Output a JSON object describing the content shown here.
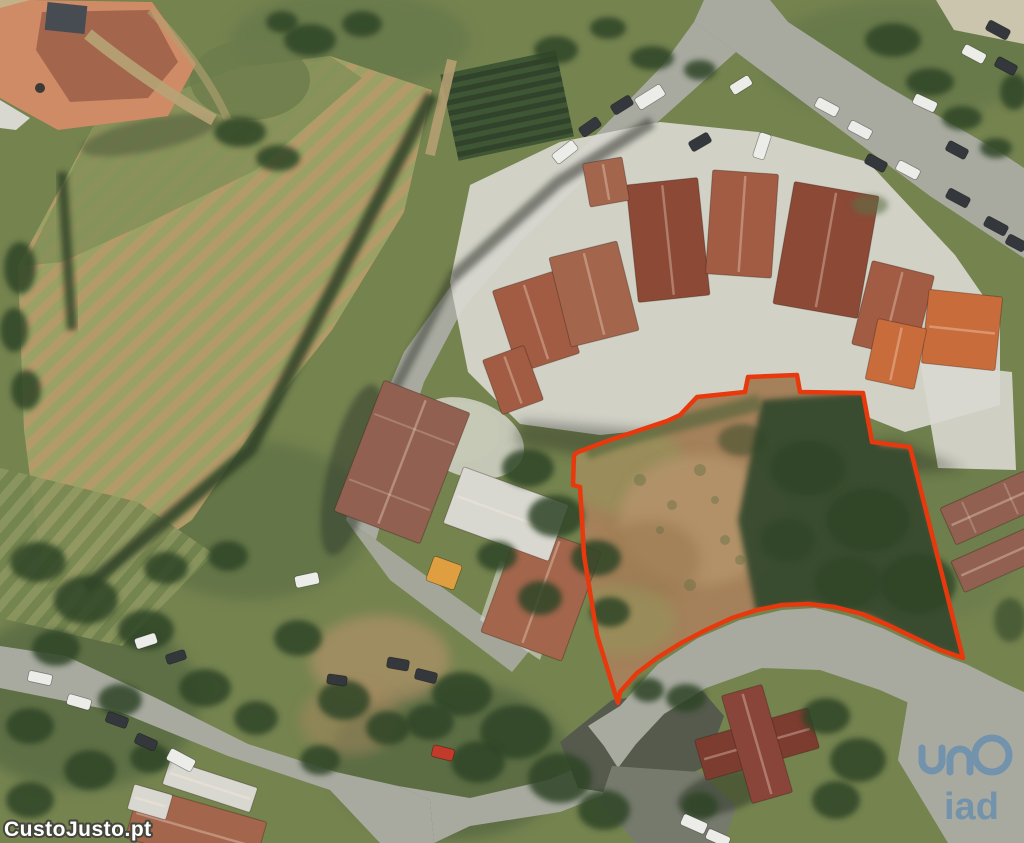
{
  "meta": {
    "canvas": {
      "width": 1024,
      "height": 843
    }
  },
  "watermarks": {
    "site": {
      "text": "CustoJusto.pt",
      "fill": "#ffffff",
      "outline": "#45453c"
    },
    "agency": {
      "text": "iad",
      "color": "#3f7cb8"
    }
  },
  "plot": {
    "outline_color": "#e8380d",
    "outline_width": 4.5,
    "outline_points": "618,703 597,635 584,555 580,487 573,485 574,455 578,452 610,440 637,431 667,421 680,415 697,397 745,392 748,377 797,375 800,392 863,393 872,442 910,447 963,658 940,650 915,638 888,625 862,614 835,607 808,604 782,605 757,610 732,618 706,630 681,643 657,658 637,673 620,692"
  },
  "palette": {
    "base": "#75834f",
    "field-tan": "#b39b69",
    "field-olive": "#9ba164",
    "veg-dark": "#2e4026",
    "garden-green": "#3f5634",
    "garden-dark": "#31432a",
    "plot-veg": "#36492d",
    "road": "#a8aaa0",
    "asphalt": "#565a4d",
    "asphalt2": "#767a6c",
    "gravel": "#cbc5ad",
    "dirt": "#a4815a",
    "dirt-light": "#b4936a",
    "scrub-green": "#5f7045",
    "wall": "#d9d8d0",
    "roof-salmon": "#cf8a66",
    "roof-salmon-dark": "#a3664c",
    "roof-terracotta": "#a15c43",
    "roof-dark": "#8b4936",
    "roof-bright": "#c96c3c",
    "roof-weathered": "#916050",
    "roof-maroon": "#7c3c30",
    "roof-maroon2": "#8a453a",
    "tree": "#2f4428",
    "red-line": "#e8380d",
    "car-white": "#ecece8",
    "car-dark": "#34383c",
    "car-red": "#c23a2a",
    "container-orange": "#df9e3f",
    "wm-fill": "#ffffff",
    "wm-stroke": "#45453c",
    "logo-blue": "#3f7cb8"
  },
  "scene": {
    "roofs": [
      {
        "x": 536,
        "y": 322,
        "w": 64,
        "h": 86,
        "r": -18,
        "c": "roof-terracotta"
      },
      {
        "x": 594,
        "y": 294,
        "w": 70,
        "h": 92,
        "r": -14,
        "c": "roof-salmon-dark"
      },
      {
        "x": 668,
        "y": 240,
        "w": 72,
        "h": 118,
        "r": -6,
        "c": "roof-dark"
      },
      {
        "x": 742,
        "y": 224,
        "w": 66,
        "h": 104,
        "r": 4,
        "c": "roof-terracotta"
      },
      {
        "x": 826,
        "y": 250,
        "w": 86,
        "h": 124,
        "r": 10,
        "c": "roof-dark"
      },
      {
        "x": 893,
        "y": 310,
        "w": 64,
        "h": 86,
        "r": 14,
        "c": "roof-terracotta"
      },
      {
        "x": 962,
        "y": 330,
        "w": 74,
        "h": 74,
        "r": 6,
        "c": "roof-bright"
      },
      {
        "x": 896,
        "y": 354,
        "w": 50,
        "h": 62,
        "r": 12,
        "c": "roof-bright"
      },
      {
        "x": 513,
        "y": 380,
        "w": 44,
        "h": 58,
        "r": -20,
        "c": "roof-terracotta"
      },
      {
        "x": 606,
        "y": 182,
        "w": 40,
        "h": 44,
        "r": -10,
        "c": "roof-salmon-dark"
      },
      {
        "x": 402,
        "y": 462,
        "w": 92,
        "h": 140,
        "r": 21,
        "c": "roof-weathered",
        "s": 1
      },
      {
        "x": 541,
        "y": 592,
        "w": 86,
        "h": 116,
        "r": 20,
        "c": "roof-salmon-dark"
      },
      {
        "x": 506,
        "y": 514,
        "w": 112,
        "h": 60,
        "r": 20,
        "c": "wall"
      },
      {
        "x": 210,
        "y": 786,
        "w": 92,
        "h": 26,
        "r": 18,
        "c": "wall"
      },
      {
        "x": 196,
        "y": 830,
        "w": 132,
        "h": 54,
        "r": 16,
        "c": "roof-salmon-dark"
      },
      {
        "x": 150,
        "y": 802,
        "w": 40,
        "h": 26,
        "r": 16,
        "c": "wall"
      },
      {
        "x": 990,
        "y": 508,
        "w": 92,
        "h": 40,
        "r": -24,
        "c": "roof-weathered",
        "s": 1
      },
      {
        "x": 996,
        "y": 560,
        "w": 84,
        "h": 34,
        "r": -24,
        "c": "roof-weathered"
      },
      {
        "x": 757,
        "y": 744,
        "w": 118,
        "h": 42,
        "r": -16,
        "c": "roof-maroon"
      },
      {
        "x": 757,
        "y": 744,
        "w": 42,
        "h": 112,
        "r": -16,
        "c": "roof-maroon2"
      }
    ],
    "trees": [
      {
        "x": 310,
        "y": 40,
        "rx": 26,
        "ry": 16
      },
      {
        "x": 362,
        "y": 24,
        "rx": 20,
        "ry": 13
      },
      {
        "x": 282,
        "y": 22,
        "rx": 16,
        "ry": 11
      },
      {
        "x": 556,
        "y": 50,
        "rx": 22,
        "ry": 14
      },
      {
        "x": 608,
        "y": 28,
        "rx": 18,
        "ry": 11
      },
      {
        "x": 652,
        "y": 58,
        "rx": 22,
        "ry": 12
      },
      {
        "x": 700,
        "y": 70,
        "rx": 16,
        "ry": 10
      },
      {
        "x": 893,
        "y": 40,
        "rx": 28,
        "ry": 17
      },
      {
        "x": 930,
        "y": 82,
        "rx": 24,
        "ry": 14
      },
      {
        "x": 962,
        "y": 118,
        "rx": 20,
        "ry": 12
      },
      {
        "x": 996,
        "y": 148,
        "rx": 16,
        "ry": 10
      },
      {
        "x": 1014,
        "y": 92,
        "rx": 14,
        "ry": 18
      },
      {
        "x": 870,
        "y": 205,
        "rx": 18,
        "ry": 10,
        "c": "scrub-green",
        "o": 0.6
      },
      {
        "x": 20,
        "y": 268,
        "rx": 16,
        "ry": 26
      },
      {
        "x": 14,
        "y": 330,
        "rx": 14,
        "ry": 22
      },
      {
        "x": 26,
        "y": 390,
        "rx": 15,
        "ry": 20
      },
      {
        "x": 240,
        "y": 132,
        "rx": 26,
        "ry": 15
      },
      {
        "x": 278,
        "y": 158,
        "rx": 22,
        "ry": 13
      },
      {
        "x": 528,
        "y": 468,
        "rx": 26,
        "ry": 19
      },
      {
        "x": 556,
        "y": 516,
        "rx": 28,
        "ry": 21
      },
      {
        "x": 596,
        "y": 558,
        "rx": 25,
        "ry": 18
      },
      {
        "x": 540,
        "y": 598,
        "rx": 22,
        "ry": 17
      },
      {
        "x": 497,
        "y": 556,
        "rx": 20,
        "ry": 15
      },
      {
        "x": 610,
        "y": 612,
        "rx": 20,
        "ry": 15
      },
      {
        "x": 808,
        "y": 468,
        "rx": 38,
        "ry": 28,
        "o": 0.75
      },
      {
        "x": 868,
        "y": 520,
        "rx": 42,
        "ry": 32,
        "o": 0.8
      },
      {
        "x": 918,
        "y": 584,
        "rx": 38,
        "ry": 30,
        "o": 0.8
      },
      {
        "x": 848,
        "y": 582,
        "rx": 34,
        "ry": 26,
        "o": 0.7
      },
      {
        "x": 788,
        "y": 540,
        "rx": 28,
        "ry": 22,
        "o": 0.65
      },
      {
        "x": 742,
        "y": 440,
        "rx": 24,
        "ry": 16,
        "o": 0.5
      },
      {
        "x": 462,
        "y": 694,
        "rx": 30,
        "ry": 22
      },
      {
        "x": 516,
        "y": 732,
        "rx": 36,
        "ry": 27
      },
      {
        "x": 560,
        "y": 778,
        "rx": 32,
        "ry": 25
      },
      {
        "x": 478,
        "y": 762,
        "rx": 27,
        "ry": 21
      },
      {
        "x": 604,
        "y": 810,
        "rx": 26,
        "ry": 20
      },
      {
        "x": 430,
        "y": 722,
        "rx": 24,
        "ry": 18
      },
      {
        "x": 686,
        "y": 698,
        "rx": 20,
        "ry": 14
      },
      {
        "x": 826,
        "y": 716,
        "rx": 24,
        "ry": 18
      },
      {
        "x": 858,
        "y": 760,
        "rx": 28,
        "ry": 22
      },
      {
        "x": 836,
        "y": 800,
        "rx": 24,
        "ry": 19
      },
      {
        "x": 700,
        "y": 806,
        "rx": 18,
        "ry": 14
      },
      {
        "x": 648,
        "y": 690,
        "rx": 16,
        "ry": 12
      },
      {
        "x": 38,
        "y": 562,
        "rx": 28,
        "ry": 20
      },
      {
        "x": 86,
        "y": 600,
        "rx": 32,
        "ry": 24
      },
      {
        "x": 146,
        "y": 630,
        "rx": 28,
        "ry": 20
      },
      {
        "x": 56,
        "y": 648,
        "rx": 24,
        "ry": 18
      },
      {
        "x": 205,
        "y": 688,
        "rx": 26,
        "ry": 19
      },
      {
        "x": 256,
        "y": 718,
        "rx": 22,
        "ry": 17
      },
      {
        "x": 166,
        "y": 568,
        "rx": 22,
        "ry": 16
      },
      {
        "x": 228,
        "y": 556,
        "rx": 20,
        "ry": 15
      },
      {
        "x": 298,
        "y": 638,
        "rx": 24,
        "ry": 18
      },
      {
        "x": 344,
        "y": 700,
        "rx": 26,
        "ry": 20
      },
      {
        "x": 388,
        "y": 728,
        "rx": 22,
        "ry": 17
      },
      {
        "x": 320,
        "y": 760,
        "rx": 20,
        "ry": 15
      },
      {
        "x": 120,
        "y": 700,
        "rx": 22,
        "ry": 16
      },
      {
        "x": 30,
        "y": 726,
        "rx": 24,
        "ry": 18
      },
      {
        "x": 90,
        "y": 770,
        "rx": 26,
        "ry": 20
      },
      {
        "x": 30,
        "y": 800,
        "rx": 24,
        "ry": 18
      },
      {
        "x": 150,
        "y": 758,
        "rx": 20,
        "ry": 15
      },
      {
        "x": 1010,
        "y": 620,
        "rx": 16,
        "ry": 22,
        "o": 0.6
      }
    ],
    "vehicles": [
      {
        "x": 998,
        "y": 30,
        "w": 24,
        "h": 11,
        "r": 28,
        "c": "car-dark"
      },
      {
        "x": 974,
        "y": 54,
        "w": 24,
        "h": 11,
        "r": 28,
        "c": "car-white"
      },
      {
        "x": 1006,
        "y": 66,
        "w": 22,
        "h": 11,
        "r": 28,
        "c": "car-dark"
      },
      {
        "x": 827,
        "y": 107,
        "w": 24,
        "h": 11,
        "r": 28,
        "c": "car-white"
      },
      {
        "x": 860,
        "y": 130,
        "w": 24,
        "h": 11,
        "r": 28,
        "c": "car-white"
      },
      {
        "x": 876,
        "y": 163,
        "w": 22,
        "h": 11,
        "r": 28,
        "c": "car-dark"
      },
      {
        "x": 908,
        "y": 170,
        "w": 24,
        "h": 11,
        "r": 28,
        "c": "car-white"
      },
      {
        "x": 925,
        "y": 103,
        "w": 24,
        "h": 11,
        "r": 25,
        "c": "car-white"
      },
      {
        "x": 957,
        "y": 150,
        "w": 22,
        "h": 11,
        "r": 28,
        "c": "car-dark"
      },
      {
        "x": 958,
        "y": 198,
        "w": 24,
        "h": 11,
        "r": 28,
        "c": "car-dark"
      },
      {
        "x": 996,
        "y": 226,
        "w": 24,
        "h": 11,
        "r": 28,
        "c": "car-dark"
      },
      {
        "x": 1016,
        "y": 243,
        "w": 20,
        "h": 11,
        "r": 28,
        "c": "car-dark"
      },
      {
        "x": 650,
        "y": 97,
        "w": 30,
        "h": 13,
        "r": -32,
        "c": "car-white"
      },
      {
        "x": 622,
        "y": 105,
        "w": 22,
        "h": 11,
        "r": -32,
        "c": "car-dark"
      },
      {
        "x": 700,
        "y": 142,
        "w": 22,
        "h": 11,
        "r": -30,
        "c": "car-dark"
      },
      {
        "x": 762,
        "y": 146,
        "w": 26,
        "h": 12,
        "r": -72,
        "c": "car-white"
      },
      {
        "x": 741,
        "y": 85,
        "w": 22,
        "h": 11,
        "r": -32,
        "c": "car-white"
      },
      {
        "x": 590,
        "y": 127,
        "w": 22,
        "h": 11,
        "r": -35,
        "c": "car-dark"
      },
      {
        "x": 565,
        "y": 152,
        "w": 26,
        "h": 12,
        "r": -38,
        "c": "car-white"
      },
      {
        "x": 40,
        "y": 678,
        "w": 24,
        "h": 11,
        "r": 12,
        "c": "car-white"
      },
      {
        "x": 79,
        "y": 702,
        "w": 24,
        "h": 11,
        "r": 16,
        "c": "car-white"
      },
      {
        "x": 117,
        "y": 720,
        "w": 22,
        "h": 11,
        "r": 20,
        "c": "car-dark"
      },
      {
        "x": 146,
        "y": 742,
        "w": 22,
        "h": 11,
        "r": 24,
        "c": "car-dark"
      },
      {
        "x": 181,
        "y": 760,
        "w": 28,
        "h": 13,
        "r": 28,
        "c": "car-white"
      },
      {
        "x": 307,
        "y": 580,
        "w": 24,
        "h": 12,
        "r": -12,
        "c": "car-white"
      },
      {
        "x": 146,
        "y": 641,
        "w": 22,
        "h": 11,
        "r": -18,
        "c": "car-white"
      },
      {
        "x": 176,
        "y": 657,
        "w": 20,
        "h": 10,
        "r": -18,
        "c": "car-dark"
      },
      {
        "x": 398,
        "y": 664,
        "w": 22,
        "h": 11,
        "r": 10,
        "c": "car-dark"
      },
      {
        "x": 426,
        "y": 676,
        "w": 22,
        "h": 11,
        "r": 14,
        "c": "car-dark"
      },
      {
        "x": 337,
        "y": 680,
        "w": 20,
        "h": 10,
        "r": 8,
        "c": "car-dark"
      },
      {
        "x": 443,
        "y": 753,
        "w": 22,
        "h": 12,
        "r": 14,
        "c": "car-red"
      },
      {
        "x": 444,
        "y": 573,
        "w": 30,
        "h": 26,
        "r": 20,
        "c": "container-orange"
      },
      {
        "x": 694,
        "y": 824,
        "w": 26,
        "h": 12,
        "r": 24,
        "c": "car-white"
      },
      {
        "x": 718,
        "y": 838,
        "w": 24,
        "h": 11,
        "r": 24,
        "c": "car-white"
      }
    ]
  }
}
